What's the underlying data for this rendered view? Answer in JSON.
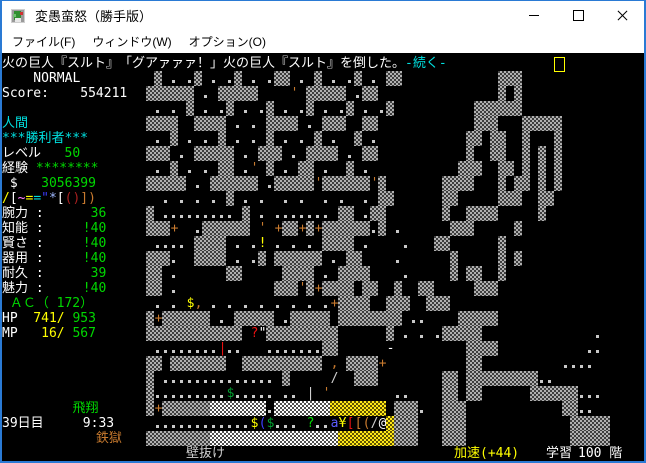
{
  "window": {
    "title": "変愚蛮怒（勝手版）",
    "buttons": {
      "minimize": "minimize",
      "maximize": "maximize",
      "close": "close"
    },
    "border_color": "#2a7ad4"
  },
  "menu": {
    "items": [
      "ファイル(F)",
      "ウィンドウ(W)",
      "オプション(O)"
    ]
  },
  "colors": {
    "wh": "#ffffff",
    "gy": "#cfcfcf",
    "gr": "#00d800",
    "dg": "#00a030",
    "cy": "#00e0e0",
    "ye": "#ffff00",
    "or": "#c87a2e",
    "rd": "#e81010",
    "dr": "#a82020",
    "bl": "#3c3cff",
    "lb": "#5c5cff",
    "pk": "#ff7fff",
    "pb": "#9fb9ff"
  },
  "message": {
    "parts": [
      {
        "t": "火の巨人『スルト』　「グアァァァ！」火の巨人『スルト』を倒した。",
        "c": "wh"
      },
      {
        "t": "-続く-",
        "c": "cy"
      }
    ],
    "cursor_x": 552
  },
  "sidebar": {
    "lines": [
      {
        "r": 1,
        "parts": [
          {
            "t": "    NORMAL",
            "c": "wh"
          }
        ]
      },
      {
        "r": 2,
        "parts": [
          {
            "t": "Score:    554211",
            "c": "wh"
          }
        ]
      },
      {
        "r": 4,
        "parts": [
          {
            "t": "人間",
            "c": "cy"
          }
        ]
      },
      {
        "r": 5,
        "parts": [
          {
            "t": "***勝利者***",
            "c": "cy"
          }
        ]
      },
      {
        "r": 6,
        "parts": [
          {
            "t": "レベル",
            "c": "wh"
          },
          {
            "t": "   50",
            "c": "gr"
          }
        ]
      },
      {
        "r": 7,
        "parts": [
          {
            "t": "経験 ",
            "c": "wh"
          },
          {
            "t": "********",
            "c": "gr"
          }
        ]
      },
      {
        "r": 8,
        "parts": [
          {
            "t": " $",
            "c": "wh"
          },
          {
            "t": "   3056399",
            "c": "gr"
          }
        ]
      },
      {
        "r": 9,
        "parts": [
          {
            "t": "/",
            "c": "ye"
          },
          {
            "t": "[",
            "c": "wh"
          },
          {
            "t": "~",
            "c": "pk"
          },
          {
            "t": "=",
            "c": "ye"
          },
          {
            "t": "=",
            "c": "cy"
          },
          {
            "t": "\"",
            "c": "bl"
          },
          {
            "t": "*",
            "c": "pb"
          },
          {
            "t": "[",
            "c": "wh"
          },
          {
            "t": "(",
            "c": "dr"
          },
          {
            "t": ")",
            "c": "dr"
          },
          {
            "t": "]",
            "c": "or"
          },
          {
            "t": ")",
            "c": "or"
          }
        ]
      },
      {
        "r": 10,
        "parts": [
          {
            "t": "腕力 :",
            "c": "wh"
          },
          {
            "t": "      36",
            "c": "gr"
          }
        ]
      },
      {
        "r": 11,
        "parts": [
          {
            "t": "知能 :",
            "c": "wh"
          },
          {
            "t": "     !40",
            "c": "gr"
          }
        ]
      },
      {
        "r": 12,
        "parts": [
          {
            "t": "賢さ :",
            "c": "wh"
          },
          {
            "t": "     !40",
            "c": "gr"
          }
        ]
      },
      {
        "r": 13,
        "parts": [
          {
            "t": "器用 :",
            "c": "wh"
          },
          {
            "t": "     !40",
            "c": "gr"
          }
        ]
      },
      {
        "r": 14,
        "parts": [
          {
            "t": "耐久 :",
            "c": "wh"
          },
          {
            "t": "      39",
            "c": "gr"
          }
        ]
      },
      {
        "r": 15,
        "parts": [
          {
            "t": "魅力 :",
            "c": "wh"
          },
          {
            "t": "     !40",
            "c": "gr"
          }
        ]
      },
      {
        "r": 16,
        "parts": [
          {
            "t": " ＡＣ（ 172）",
            "c": "gr"
          }
        ]
      },
      {
        "r": 17,
        "parts": [
          {
            "t": "HP",
            "c": "wh"
          },
          {
            "t": "  741/",
            "c": "ye"
          },
          {
            "t": " 953",
            "c": "gr"
          }
        ]
      },
      {
        "r": 18,
        "parts": [
          {
            "t": "MP",
            "c": "wh"
          },
          {
            "t": "   16/",
            "c": "ye"
          },
          {
            "t": " 567",
            "c": "gr"
          }
        ]
      },
      {
        "r": 23,
        "parts": [
          {
            "t": "         飛翔",
            "c": "gr"
          }
        ]
      },
      {
        "r": 24,
        "parts": [
          {
            "t": "39日目     9:33",
            "c": "wh"
          }
        ]
      },
      {
        "r": 25,
        "parts": [
          {
            "t": "            鉄獄",
            "c": "or"
          }
        ]
      }
    ]
  },
  "status_bar": {
    "items": [
      {
        "x": 184,
        "t": "壁抜け",
        "c": "gy"
      },
      {
        "x": 452,
        "t": "加速(+44)",
        "c": "ye"
      },
      {
        "x": 544,
        "t": "学習",
        "c": "wh"
      },
      {
        "x": 576,
        "t": "100 階",
        "c": "wh"
      }
    ]
  },
  "map": {
    "cell_w": 8,
    "cell_h": 15,
    "top_pad": 3,
    "legend": {
      "#": {
        "type": "block",
        "c1": "#b0b0b0",
        "c2": "#3e3e3e",
        "name": "granite-wall"
      },
      "%": {
        "type": "block",
        "c1": "#ffffff",
        "c2": "#4e4e4e",
        "name": "quartz-wall"
      },
      "Y": {
        "type": "block",
        "c1": "#ffe818",
        "c2": "#5f5300",
        "name": "treasure-vein"
      },
      ".": {
        "type": "dot",
        "color": "#c8c8c8",
        "name": "floor"
      },
      "'": {
        "type": "glyph",
        "ch": "'",
        "c": "or",
        "name": "open-door"
      },
      "+": {
        "type": "glyph",
        "ch": "+",
        "c": "or",
        "name": "closed-door"
      },
      ",": {
        "type": "glyph",
        "ch": ",",
        "c": "or",
        "name": "item"
      },
      "!": {
        "type": "glyph",
        "ch": "!",
        "c": "ye",
        "name": "potion"
      },
      "$": {
        "type": "glyph",
        "ch": "$",
        "c": "ye",
        "name": "gold"
      },
      "g": {
        "type": "glyph",
        "ch": "$",
        "c": "dg",
        "name": "gold-green"
      },
      "G": {
        "type": "glyph",
        "ch": "?",
        "c": "gr",
        "name": "scroll-green"
      },
      "R": {
        "type": "glyph",
        "ch": "?",
        "c": "rd",
        "name": "scroll-red"
      },
      "d": {
        "type": "glyph",
        "ch": "|",
        "c": "rd",
        "name": "weapon-red"
      },
      "I": {
        "type": "glyph",
        "ch": "|",
        "c": "gy",
        "name": "weapon-white"
      },
      "q": {
        "type": "glyph",
        "ch": "\"",
        "c": "wh",
        "name": "amulet"
      },
      "a": {
        "type": "glyph",
        "ch": "a",
        "c": "lb",
        "name": "monster-ant"
      },
      "¥": {
        "type": "glyph",
        "ch": "¥",
        "c": "ye",
        "name": "item-yen"
      },
      "r": {
        "type": "glyph",
        "ch": "[",
        "c": "rd",
        "name": "armor-red"
      },
      "o": {
        "type": "glyph",
        "ch": "[",
        "c": "or",
        "name": "armor-orange"
      },
      "c": {
        "type": "glyph",
        "ch": "(",
        "c": "or",
        "name": "soft-armor"
      },
      "b": {
        "type": "glyph",
        "ch": "(",
        "c": "bl",
        "name": "soft-armor-blue"
      },
      "/": {
        "type": "glyph",
        "ch": "/",
        "c": "gy",
        "name": "polearm"
      },
      "M": {
        "type": "glyph",
        "ch": "-",
        "c": "wh",
        "name": "wand"
      },
      "@": {
        "type": "glyph",
        "ch": "@",
        "c": "wh",
        "name": "player"
      }
    },
    "rows": [
      {
        "r": 1,
        "cells": {
          "19": "#",
          "21": ". .",
          "24": "#",
          "26": ". .",
          "29": "#",
          "31": ". .",
          "34": "##",
          "37": ".",
          "39": "#",
          "41": ". .",
          "44": "#",
          "46": ".",
          "48": "##",
          "62": "###"
        }
      },
      {
        "r": 2,
        "cells": {
          "18": "######",
          "25": ".",
          "27": "#####",
          "36": "'",
          "38": "#####",
          "44": ".",
          "45": "##",
          "62": "#",
          "64": "#"
        }
      },
      {
        "r": 3,
        "cells": {
          "19": ". .",
          "23": "#",
          "25": ". .",
          "28": "#",
          "30": ". .",
          "33": "#",
          "35": ". .",
          "38": "#",
          "40": ". .",
          "43": "#",
          "45": ". .",
          "48": "#",
          "59": "######"
        }
      },
      {
        "r": 4,
        "cells": {
          "18": "####",
          "24": "####",
          "29": ". .",
          "33": "####",
          "38": ".",
          "40": "###",
          "45": "##",
          "59": "###",
          "65": "#####"
        }
      },
      {
        "r": 5,
        "cells": {
          "19": ".",
          "21": "#",
          "23": ". .",
          "27": "#",
          "29": ". .",
          "33": "#",
          "35": ". .",
          "39": "#",
          "41": ".",
          "44": "#",
          "46": ".",
          "58": "##",
          "61": "##",
          "65": "#",
          "69": "#"
        }
      },
      {
        "r": 6,
        "cells": {
          "18": "###",
          "22": ".",
          "24": "#####",
          "30": ".",
          "32": "###",
          "36": ".",
          "38": "####",
          "43": ".",
          "45": "##",
          "58": "#",
          "61": "##",
          "65": "#",
          "67": "#",
          "69": "#"
        }
      },
      {
        "r": 7,
        "cells": {
          "19": ".",
          "21": "#",
          "23": ". .",
          "27": "##",
          "30": ".",
          "31": "'",
          "33": "#",
          "35": ".",
          "37": "##",
          "40": ".",
          "43": "#",
          "45": ".",
          "57": "###",
          "62": "##",
          "65": "#",
          "67": "#",
          "69": "#"
        }
      },
      {
        "r": 8,
        "cells": {
          "18": "#####",
          "24": ".",
          "26": "######",
          "33": ".",
          "34": "#####",
          "39": "'",
          "40": "######",
          "46": "'",
          "47": "#",
          "55": "####",
          "62": "#",
          "64": "##",
          "67": "#",
          "69": "#"
        }
      },
      {
        "r": 9,
        "cells": {
          "20": ". . . .",
          "28": "#",
          "30": ". .",
          "35": ". .",
          "40": ". .",
          "45": ".",
          "47": "##",
          "55": "##",
          "62": "###",
          "67": "##"
        }
      },
      {
        "r": 10,
        "cells": {
          "18": "#",
          "20": ".........",
          "30": "#",
          "32": ".",
          "34": ".......",
          "42": "##",
          "45": ".",
          "46": "##",
          "55": "#",
          "58": "####",
          "67": "#"
        }
      },
      {
        "r": 11,
        "cells": {
          "18": "###",
          "21": "+",
          "24": ".",
          "25": "######",
          "32": "'",
          "34": "+",
          "35": "##",
          "37": "+",
          "38": "#",
          "39": "+",
          "40": "######",
          "46": ".",
          "47": "#",
          "49": ".",
          "56": "###",
          "64": "#"
        }
      },
      {
        "r": 12,
        "cells": {
          "19": "....",
          "24": "####",
          "29": ". .",
          "32": "!",
          "34": ". . .",
          "40": "####",
          "45": ".",
          "50": ".",
          "54": "##",
          "62": "#"
        }
      },
      {
        "r": 13,
        "cells": {
          "18": "###",
          "21": ".",
          "24": "####",
          "29": ". .",
          "32": "#",
          "34": "######",
          "41": ".",
          "43": "##",
          "49": ".",
          "56": "#",
          "62": "#",
          "64": "#"
        }
      },
      {
        "r": 14,
        "cells": {
          "18": "##",
          "21": ".",
          "28": "##",
          "35": "####",
          "40": ".",
          "42": "####",
          "50": ".",
          "56": "#",
          "58": "##",
          "62": "#"
        }
      },
      {
        "r": 15,
        "cells": {
          "18": "##",
          "21": ".",
          "34": "###",
          "37": "'",
          "38": "#",
          "39": "+",
          "40": "####",
          "45": "##",
          "49": "#",
          "52": "##",
          "59": "###"
        }
      },
      {
        "r": 16,
        "cells": {
          "19": ".",
          "21": ".",
          "23": "$",
          "24": ",",
          "26": ". . . . . . . .",
          "41": "+",
          "42": "####",
          "48": "###",
          "53": "###"
        }
      },
      {
        "r": 17,
        "cells": {
          "18": "#",
          "19": "+",
          "20": "######",
          "27": ".",
          "29": "#####",
          "35": ".",
          "36": "#####",
          "42": "######",
          "48": "##",
          "51": "..",
          "57": "#####"
        }
      },
      {
        "r": 18,
        "cells": {
          "18": "############",
          "31": "R",
          "32": "q",
          "33": "#########",
          "48": "#",
          "50": ".",
          "52": ".",
          "54": ".",
          "55": "#####",
          "74": "."
        }
      },
      {
        "r": 19,
        "cells": {
          "19": "........",
          "27": "d",
          "28": "..",
          "33": ".......",
          "40": "##",
          "48": "M",
          "58": "####",
          "73": ".."
        }
      },
      {
        "r": 20,
        "cells": {
          "18": "##",
          "21": "#######",
          "30": "##########",
          "41": ",",
          "43": "####",
          "47": "+",
          "58": "##",
          "70": "...."
        }
      },
      {
        "r": 21,
        "cells": {
          "18": "#",
          "20": "..............",
          "35": "#",
          "41": "/",
          "44": "###",
          "55": "##",
          "58": "##",
          "60": "#######",
          "67": ".."
        }
      },
      {
        "r": 22,
        "cells": {
          "18": "#",
          "19": ".........",
          "28": "g",
          "29": ".....",
          "35": "..",
          "38": "I",
          "40": "'",
          "49": "..",
          "55": "##",
          "58": "##",
          "66": "######",
          "72": "..."
        }
      },
      {
        "r": 23,
        "cells": {
          "18": "#",
          "19": "+",
          "20": "######",
          "26": "%%%%%%%",
          "33": ".",
          "34": "%%%%%%%",
          "41": "YYYYYYY",
          "49": "###",
          "52": ".",
          "55": "###",
          "70": "##",
          "72": ".."
        }
      },
      {
        "r": 24,
        "cells": {
          "19": "............",
          "31": "$",
          "32": "b",
          "33": "g",
          "34": "...",
          "38": "G",
          "39": "..",
          "41": "a",
          "42": "¥",
          "43": "r",
          "44": "o",
          "45": "c",
          "46": "/",
          "47": "@",
          "48": "Y",
          "49": "###",
          "55": "###",
          "71": "#####"
        }
      },
      {
        "r": 25,
        "cells": {
          "18": "########",
          "26": "%%%%%%%%%%%%%%%%",
          "42": "YYYYYYY",
          "49": "###",
          "55": "###",
          "71": "#####"
        }
      }
    ]
  }
}
